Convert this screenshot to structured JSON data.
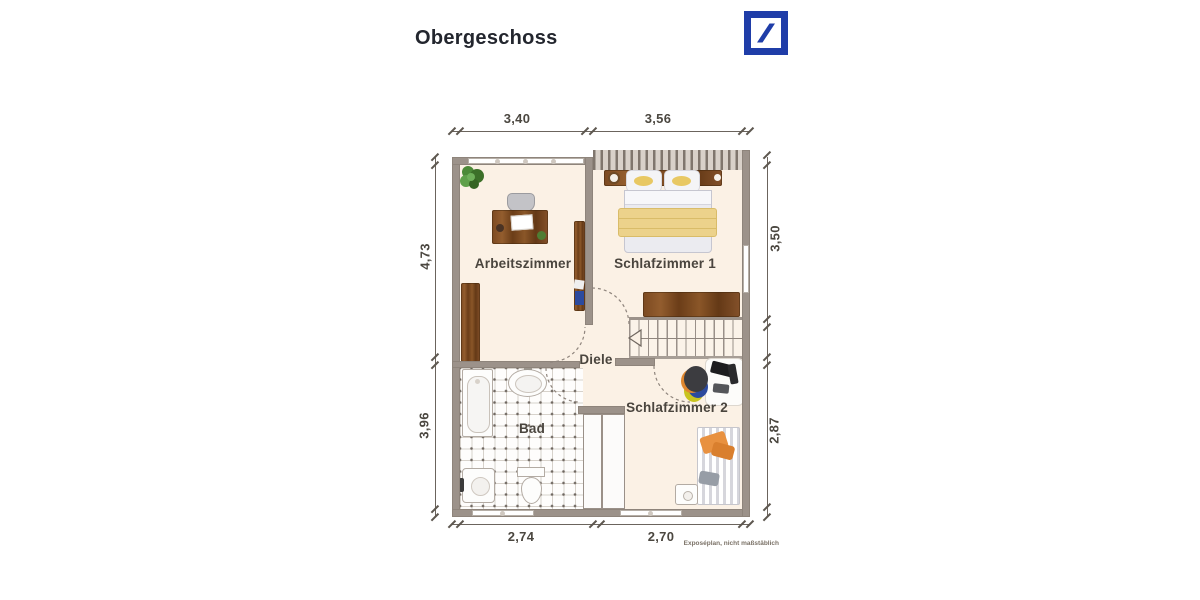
{
  "header": {
    "title": "Obergeschoss"
  },
  "logo": {
    "brand_color": "#1f3da8"
  },
  "plan": {
    "rooms": {
      "arbeitszimmer": "Arbeitszimmer",
      "schlafzimmer1": "Schlafzimmer 1",
      "diele": "Diele",
      "bad": "Bad",
      "schlafzimmer2": "Schlafzimmer 2"
    },
    "dimensions": {
      "top": [
        "3,40",
        "3,56"
      ],
      "bottom": [
        "2,74",
        "2,70"
      ],
      "left": [
        "4,73",
        "3,96"
      ],
      "right": [
        "3,50",
        "2,87"
      ]
    },
    "footnote": "Exposéplan, nicht maßstäblich"
  },
  "colors": {
    "wall": "#9c928a",
    "floor": "#fbf1e5",
    "wood": "#7d4b23",
    "logo_blue": "#1f3da8",
    "dim_text": "#4b4740"
  }
}
